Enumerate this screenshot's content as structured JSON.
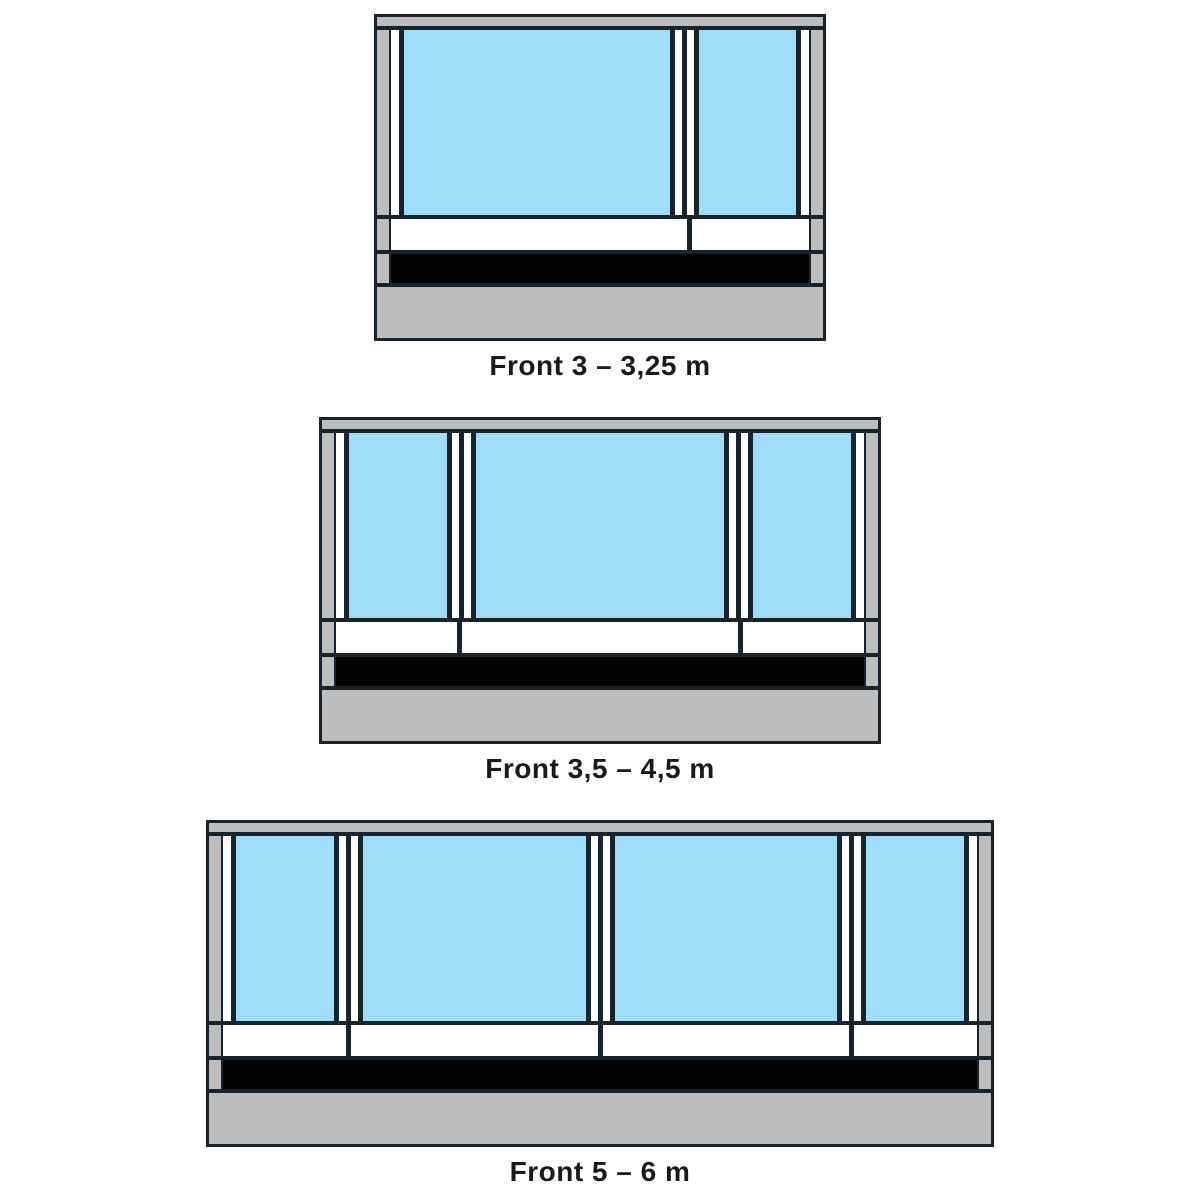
{
  "colors": {
    "frame_gray": "#bdbdbd",
    "window_blue": "#9fdcf7",
    "outline_dark": "#18232e",
    "skirt_black": "#040404",
    "trim_white": "#ffffff",
    "label_text": "#1a1a1a",
    "background": "#ffffff"
  },
  "diagrams": [
    {
      "label": "Front 3 – 3,25 m",
      "window_count": 2
    },
    {
      "label": "Front 3,5 – 4,5 m",
      "window_count": 3
    },
    {
      "label": "Front 5 – 6 m",
      "window_count": 4
    }
  ]
}
